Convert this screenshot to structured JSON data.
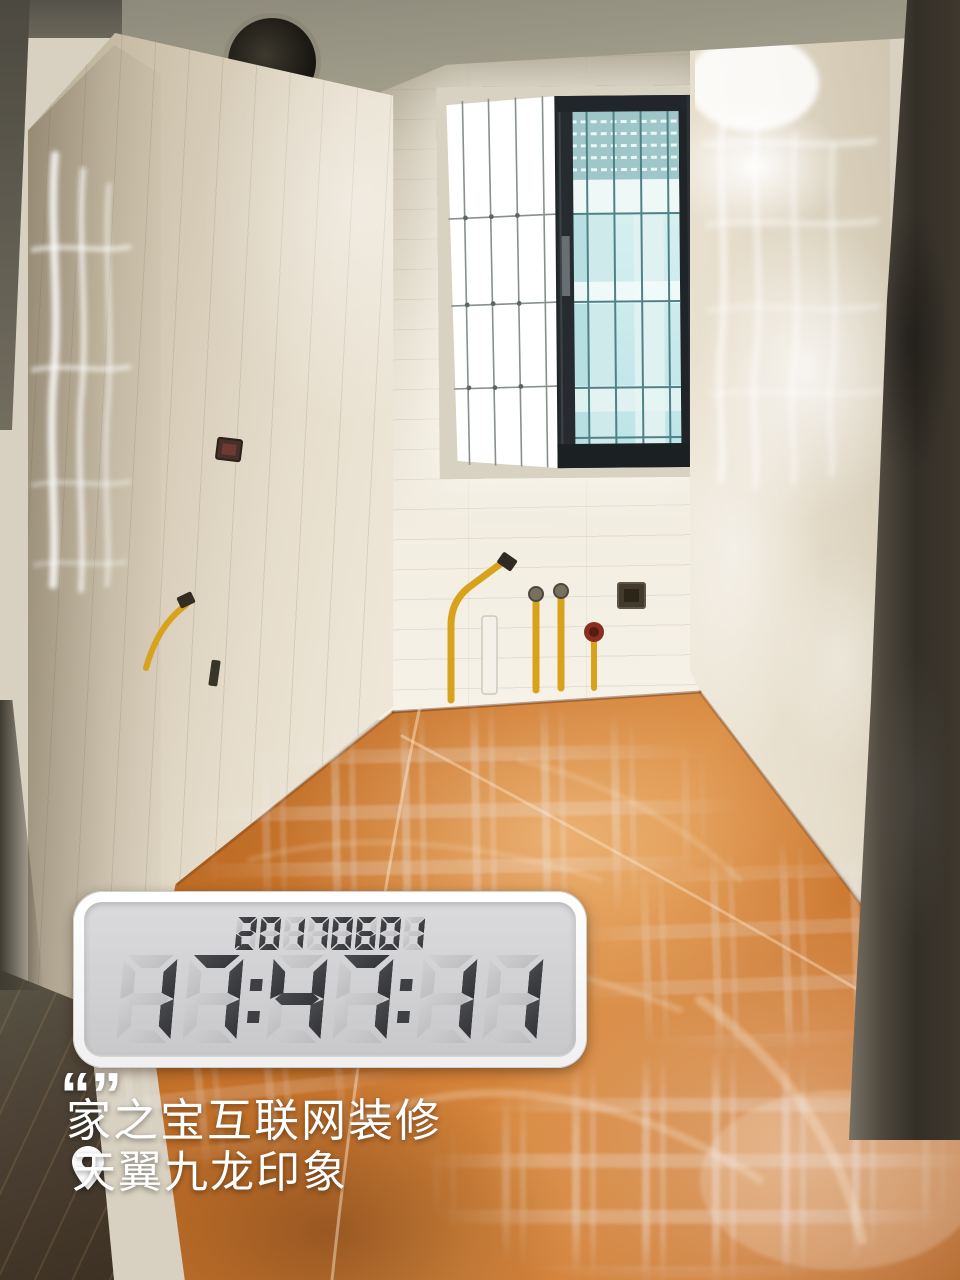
{
  "scene": {
    "description_label": "renovation-room-photo",
    "floor_cover_color": "#c9722f",
    "wall_tile_color": "#efe8da",
    "window_glass_color": "#cdeaec",
    "doorframe_concrete_color": "#3e382e"
  },
  "clock": {
    "date": "2017.06.01",
    "time": "17:47:11",
    "panel_color": "#d2d2d4",
    "segment_on_color": "#3d3f43",
    "segment_off_color": "#c6c6c8",
    "frame_color": "#ffffff"
  },
  "captions": {
    "quote_open": "“",
    "quote_close": "”",
    "brand_text": "家之宝互联网装修",
    "location_text": "天翼九龙印象",
    "text_color": "#ffffff"
  },
  "icons": {
    "location_pin": "location-pin-icon",
    "ceiling_vent": "ceiling-vent-hole"
  }
}
